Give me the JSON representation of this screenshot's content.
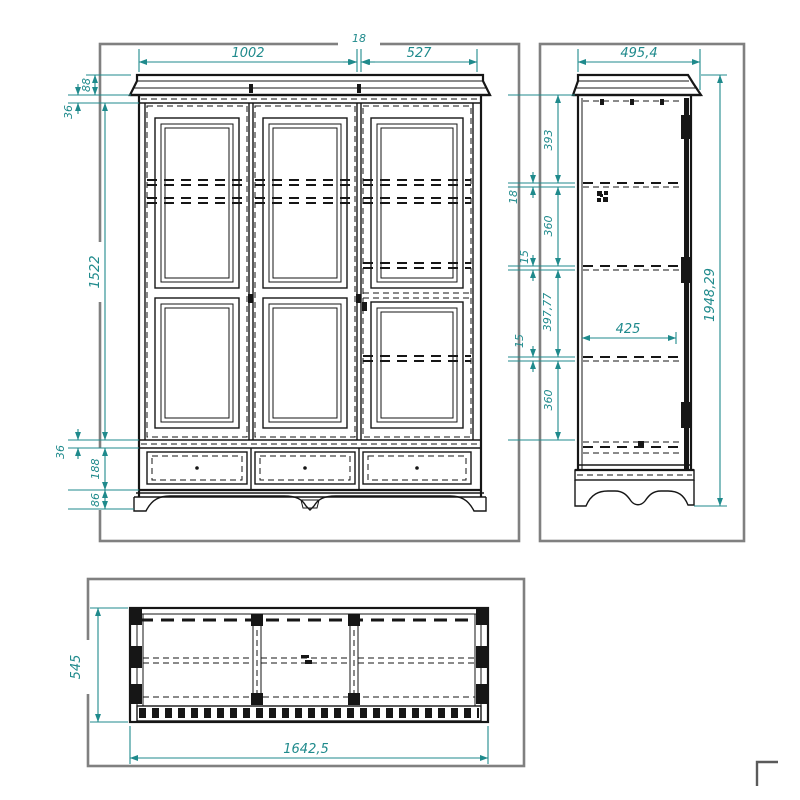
{
  "title": "wardrobe three-view technical drawing",
  "colors": {
    "dimension": "#1f8a8c",
    "frame": "#808080",
    "line": "#161616"
  },
  "views": {
    "front": {
      "name": "front-view",
      "dims": {
        "width_left": "1002",
        "gap": "18",
        "width_right": "527",
        "cornice_h": "88",
        "frieze_h": "36",
        "door_h": "1522",
        "rail_h": "36",
        "drawer_h": "188",
        "base_h": "86"
      }
    },
    "side": {
      "name": "side-view",
      "dims": {
        "depth": "495,4",
        "seg1": "393",
        "shelf_thickness": "18",
        "seg2": "360",
        "gap1": "15",
        "seg3": "397,77",
        "gap2": "15",
        "seg4": "360",
        "inner_depth": "425",
        "height": "1948,29"
      }
    },
    "top": {
      "name": "top-view",
      "dims": {
        "depth": "545",
        "width": "1642,5"
      }
    }
  }
}
